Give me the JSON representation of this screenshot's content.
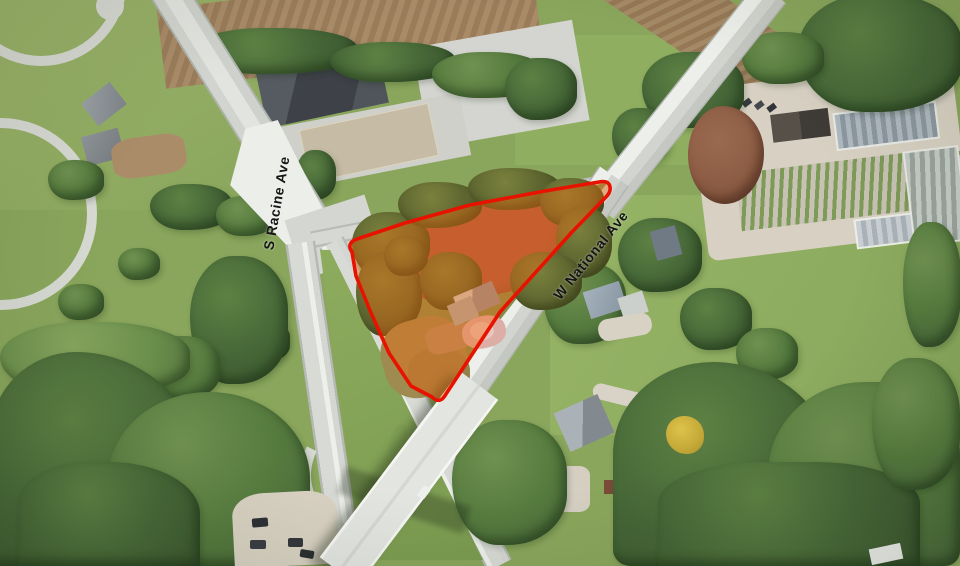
{
  "map": {
    "type": "aerial-satellite-view",
    "labels": {
      "s_racine": "S Racine Ave",
      "w_national": "W National Ave"
    },
    "parcel": {
      "outline_color": "#e81200",
      "fill_color": "rgba(246,104,10,0.38)",
      "path": "M 352 252 Q 346 243 357 239 L 405 223 L 470 205 L 545 191 L 599 182 Q 609 180 610 187 Q 611 192 606 197 L 572 232 L 500 312 L 446 394 Q 440 405 432 397 L 411 386 L 389 353 L 371 313 L 356 276 Z"
    }
  }
}
